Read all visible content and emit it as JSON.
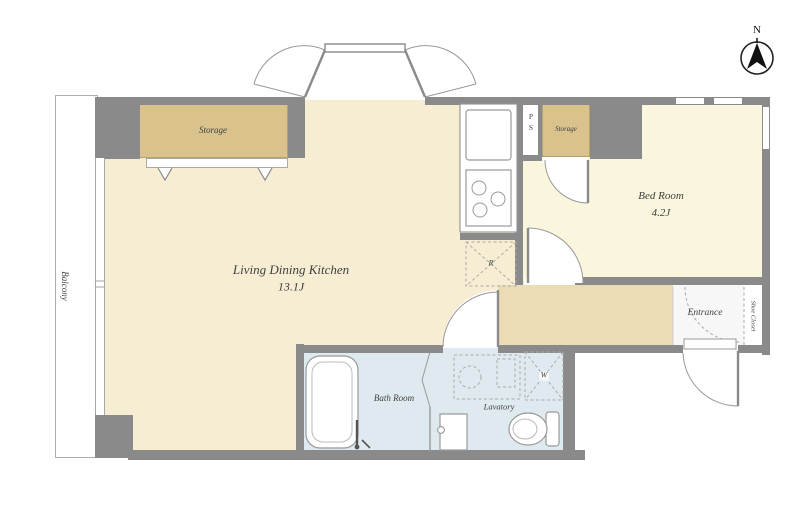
{
  "compass": {
    "north_label": "N"
  },
  "rooms": {
    "living_dining_kitchen": {
      "name": "Living Dining Kitchen",
      "size": "13.1J"
    },
    "bed_room": {
      "name": "Bed Room",
      "size": "4.2J"
    },
    "balcony": {
      "name": "Balcony"
    },
    "bath_room": {
      "name": "Bath Room"
    },
    "lavatory": {
      "name": "Lavatory"
    },
    "entrance": {
      "name": "Entrance"
    },
    "shoe_closet": {
      "name": "Shoe Closet"
    },
    "storage_living": {
      "name": "Storage"
    },
    "storage_hall": {
      "name": "Storage"
    },
    "pipe_space": {
      "letter_top": "P",
      "letter_bottom": "S"
    }
  },
  "fixtures": {
    "refrigerator_label": "R",
    "washing_machine_label": "W"
  },
  "colors": {
    "wall": "#8a8a8a",
    "ldk_floor": "#f7edd3",
    "bedroom_floor": "#faf6dd",
    "corridor_floor": "#ebdcb5",
    "wet_area_floor": "#dfeaf0",
    "storage_fill": "#d9c28c",
    "entrance_floor": "#f7f7f7",
    "line": "#999999",
    "text": "#3f3f3f"
  }
}
